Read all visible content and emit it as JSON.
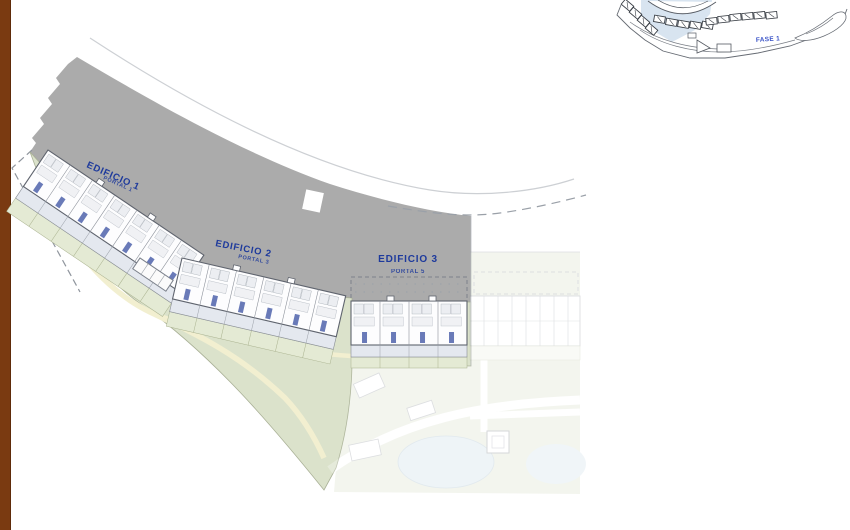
{
  "plan": {
    "buildings": [
      {
        "name": "EDIFICIO 1",
        "portal": "PORTAL 1"
      },
      {
        "name": "EDIFICIO 2",
        "portal": "PORTAL 3"
      },
      {
        "name": "EDIFICIO 3",
        "portal": "PORTAL 5"
      }
    ]
  },
  "inset": {
    "phase_label": "FASE 1"
  },
  "colors": {
    "label_blue": "#1e3a9c",
    "phase_label_blue": "#3c55c8",
    "gray_band": "#ababab",
    "green_landscape": "#dbe2cb",
    "garden_green": "#e4ead4",
    "path_yellow": "#f2efd0",
    "terrace_gray_blue": "#e4e8ef",
    "unit_accent_blue": "#4f63ac",
    "pool_blue": "#c9dde8",
    "inset_highlight_blue": "#d8e4f0",
    "left_bar_brown": "#7a3a11"
  }
}
